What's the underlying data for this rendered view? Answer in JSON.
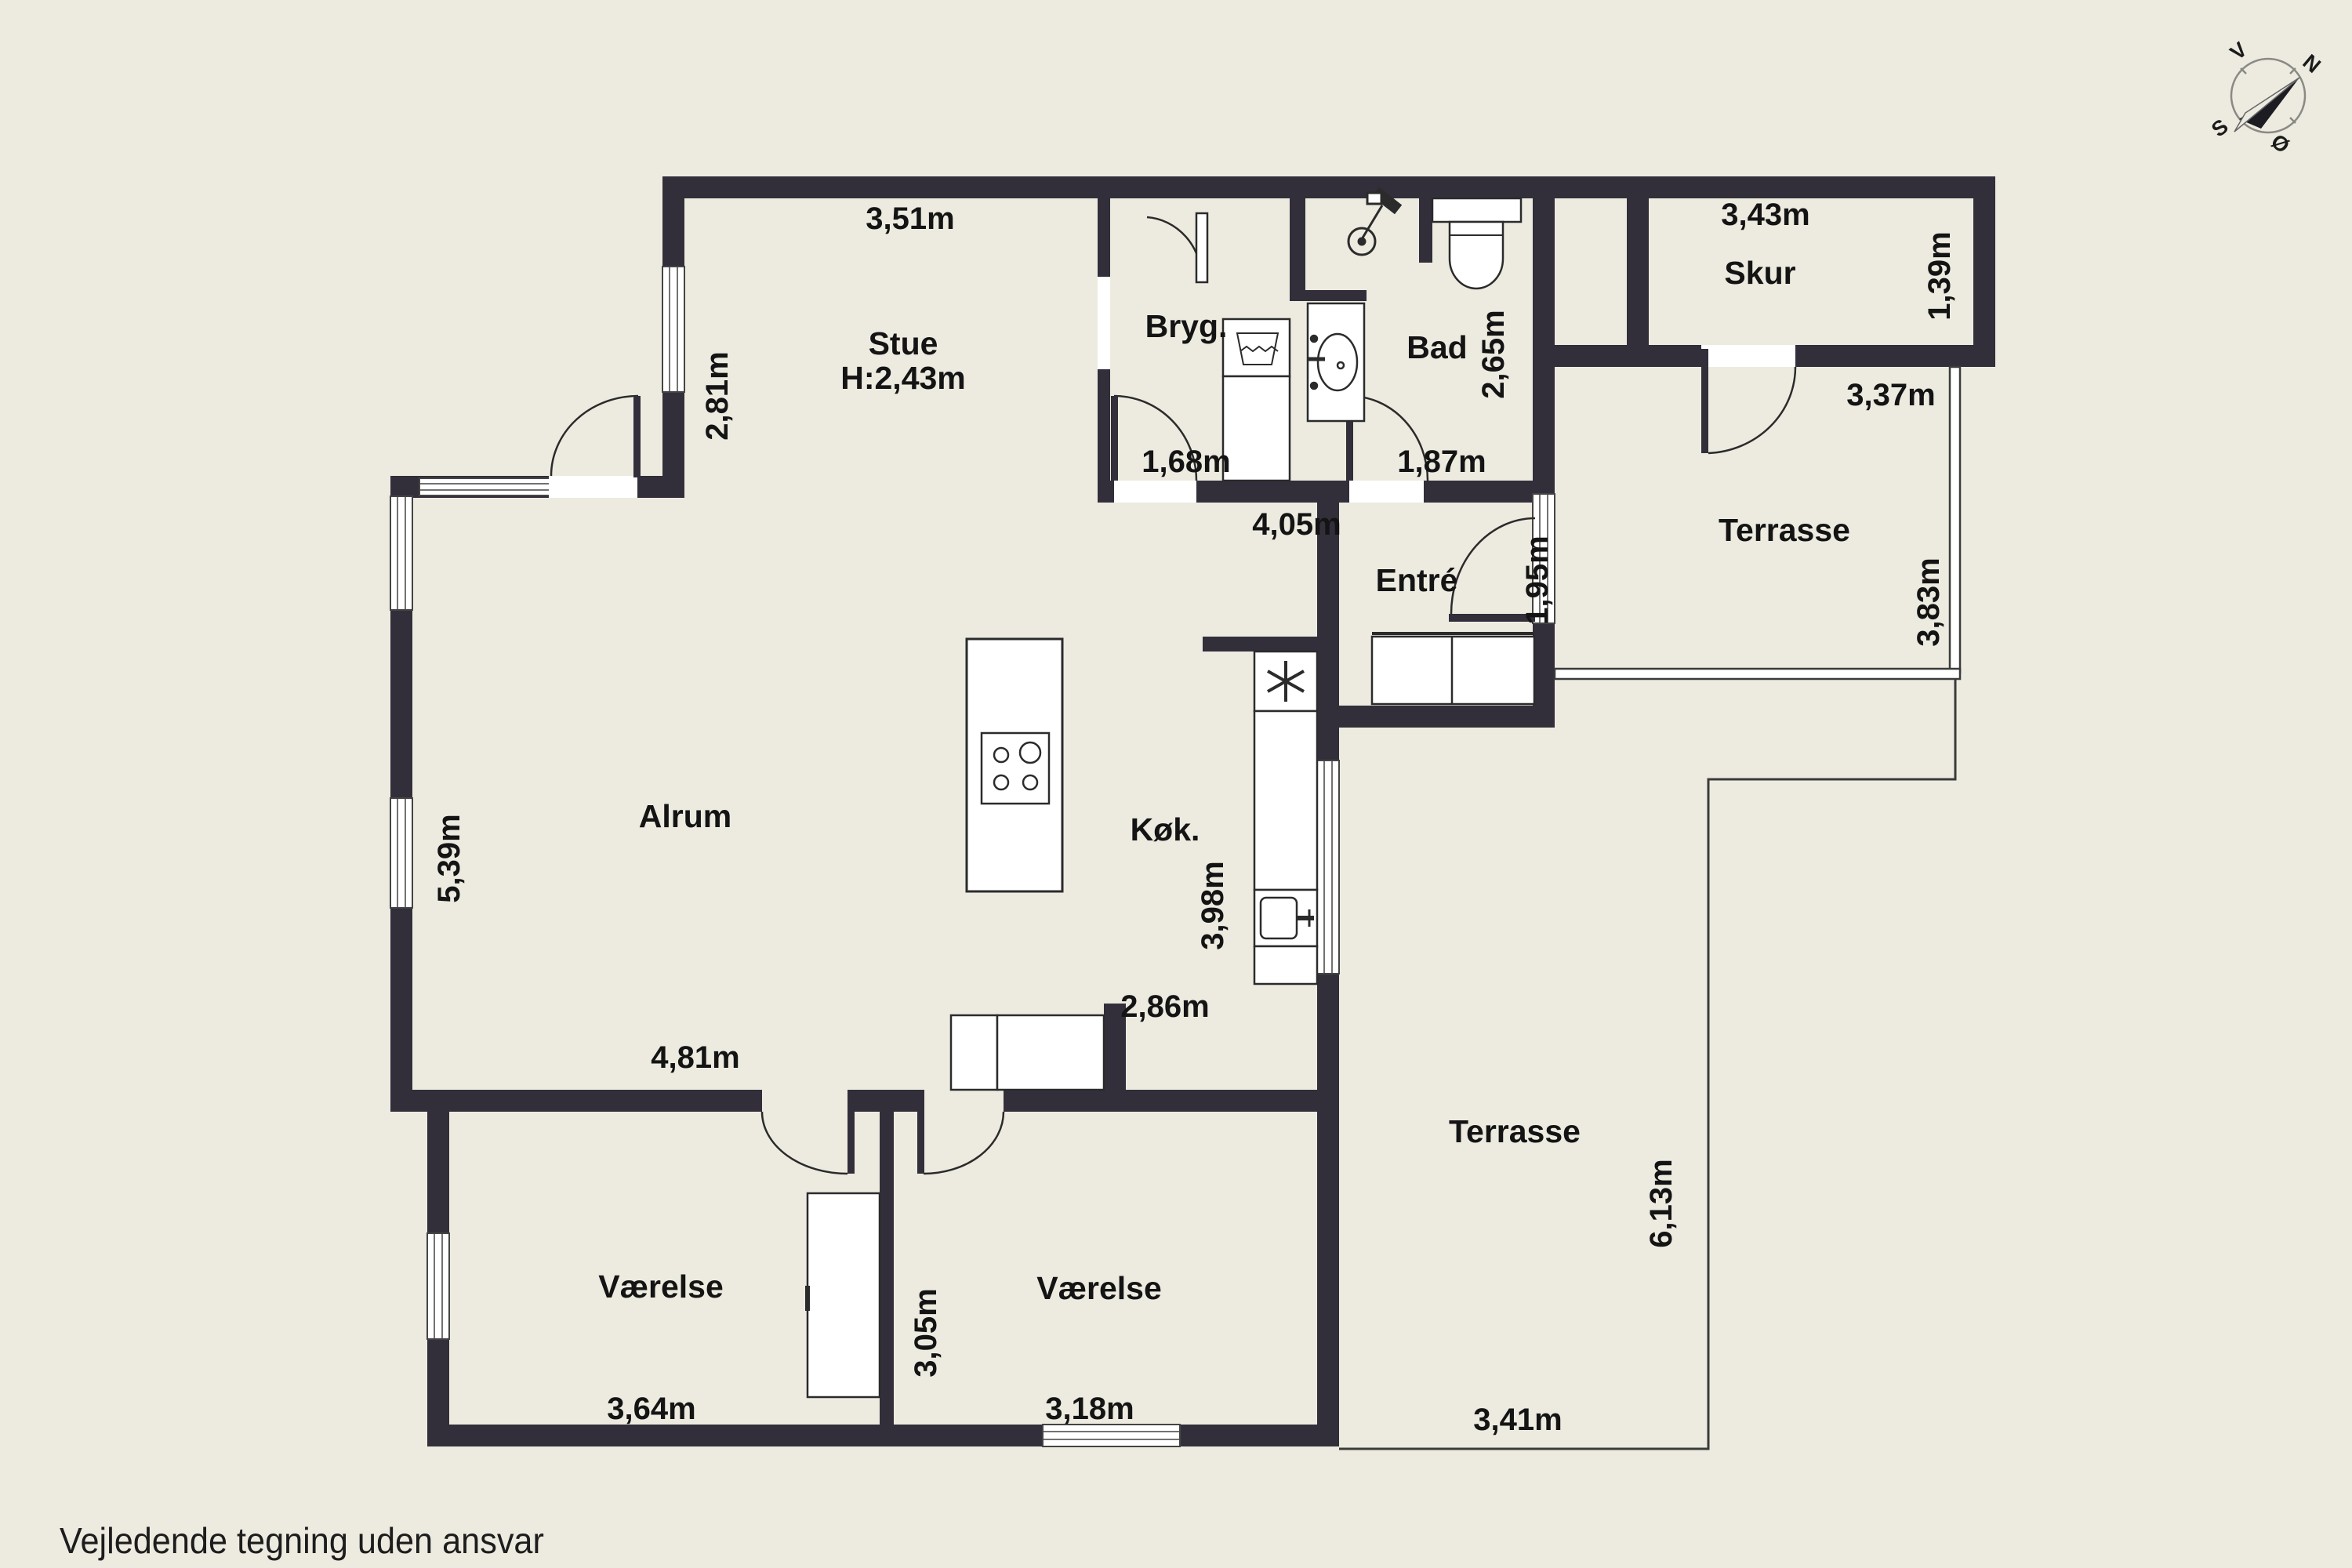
{
  "footer_note": "Vejledende tegning uden ansvar",
  "colors": {
    "background": "#EDEBE0",
    "wall": "#322F3B",
    "thin_line": "#3B3B3B",
    "fixture_white": "#FFFFFF",
    "text": "#141414"
  },
  "compass": {
    "north": "N",
    "east": "Ø",
    "south": "S",
    "west": "V"
  },
  "rooms": {
    "stue": "Stue",
    "stue_ceiling_height": "H:2,43m",
    "bryggers": "Bryg.",
    "bad": "Bad",
    "skur": "Skur",
    "entre": "Entré",
    "alrum": "Alrum",
    "kokken": "Køk.",
    "vaerelse_left": "Værelse",
    "vaerelse_right": "Værelse",
    "terrasse_upper": "Terrasse",
    "terrasse_lower": "Terrasse"
  },
  "dimensions": {
    "stue_width": "3,51m",
    "stue_left_side": "2,81m",
    "bryggers_width": "1,68m",
    "bad_door_width": "1,87m",
    "bad_depth": "2,65m",
    "alrum_top_width": "4,05m",
    "entre_door": "1,95m",
    "skur_width": "3,43m",
    "skur_depth": "1,39m",
    "terrasse_upper_width": "3,37m",
    "terrasse_upper_depth": "3,83m",
    "alrum_left_side": "5,39m",
    "kokken_depth": "3,98m",
    "kokken_width": "2,86m",
    "alrum_bottom_width": "4,81m",
    "terrasse_lower_depth": "6,13m",
    "terrasse_lower_width": "3,41m",
    "vaerelse_left_width": "3,64m",
    "vaerelse_depth": "3,05m",
    "vaerelse_right_width": "3,18m"
  }
}
